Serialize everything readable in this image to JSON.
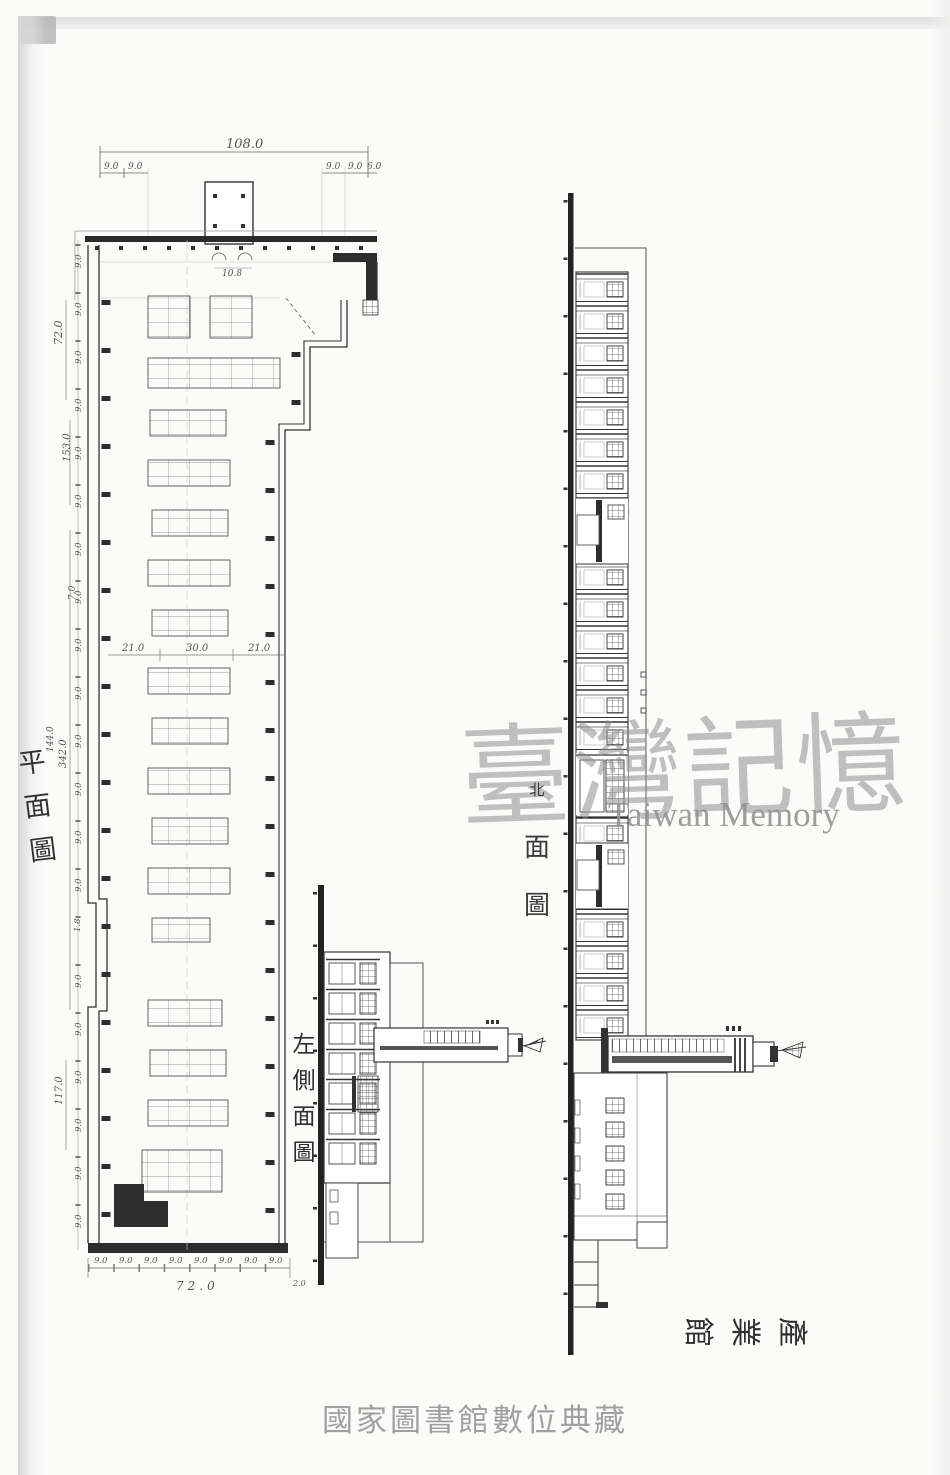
{
  "watermark": {
    "cjk": "臺灣記憶",
    "latin": "Taiwan Memory"
  },
  "caption": "國家圖書館數位典藏",
  "labels": {
    "plan": "平面圖",
    "side_elevation": "左側面圖",
    "front_elevation": "北面圖",
    "building": "產業館"
  },
  "dims": {
    "top_total": "108.0",
    "seg": "9.0",
    "seg_end": "6.0",
    "width_a": "21.0",
    "width_b": "30.0",
    "width_c": "21.0",
    "left_72": "72.0",
    "left_153": "153.0",
    "left_342": "342.0",
    "left_144": "144.0",
    "left_117": "117.0",
    "left_7": "7.0",
    "left_18": "1.8",
    "bottom_total": "72.0",
    "bottom_end": "2.0",
    "porch": "10.8"
  }
}
